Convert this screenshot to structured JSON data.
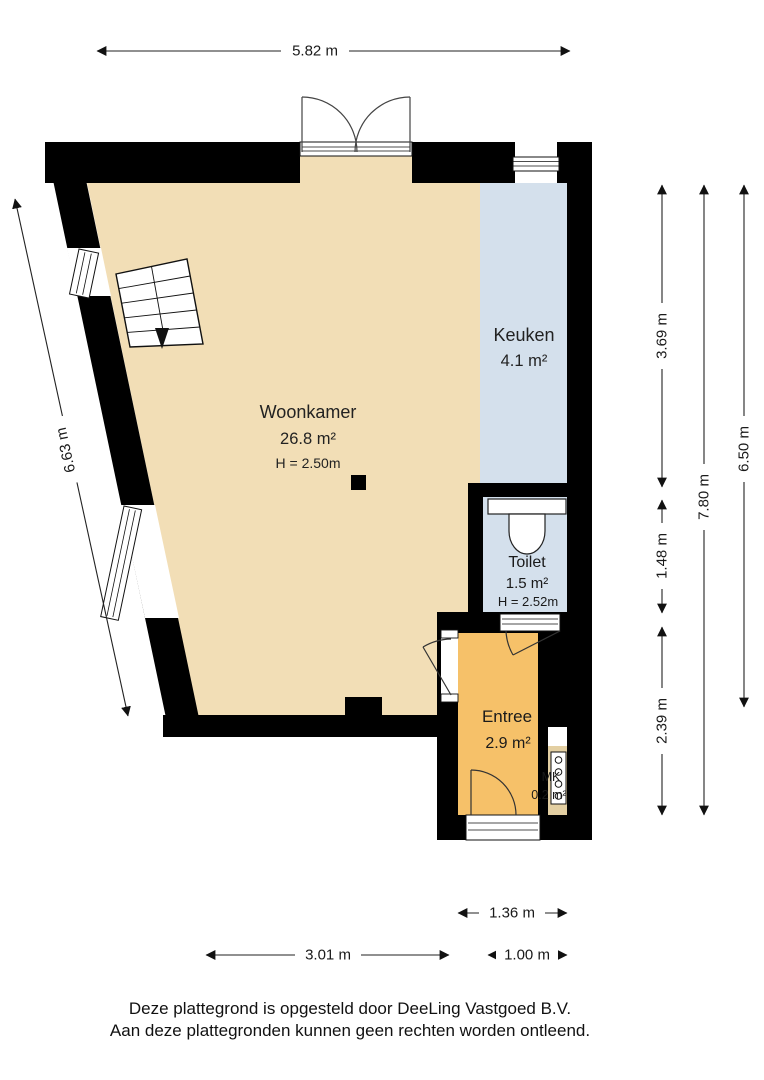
{
  "plan_type": "floorplan",
  "rooms": {
    "woonkamer": {
      "name": "Woonkamer",
      "area": "26.8 m²",
      "height_label": "H = 2.50m"
    },
    "keuken": {
      "name": "Keuken",
      "area": "4.1 m²"
    },
    "toilet": {
      "name": "Toilet",
      "area": "1.5 m²",
      "height_label": "H = 2.52m"
    },
    "entree": {
      "name": "Entree",
      "area": "2.9 m²"
    },
    "meterkast": {
      "name": "MK",
      "area": "0.2 m²"
    }
  },
  "dimensions": {
    "top_width": "5.82 m",
    "left_height": "6.63 m",
    "right_segments": [
      "3.69 m",
      "1.48 m",
      "2.39 m"
    ],
    "right_total": "7.80 m",
    "right_outer": "6.50 m",
    "bottom_entree_width": "1.36 m",
    "bottom_left_width": "3.01 m",
    "bottom_right_width": "1.00 m"
  },
  "footer": {
    "line1": "Deze plattegrond is opgesteld door DeeLing Vastgoed B.V.",
    "line2": "Aan deze plattegronden kunnen geen rechten worden ontleend."
  },
  "colors": {
    "living": "#f2deb6",
    "kitchen": "#d4e0ec",
    "toilet": "#d4e0ec",
    "entry": "#f6c169",
    "meter_closet": "#e3cfa2",
    "wall": "#000000"
  }
}
